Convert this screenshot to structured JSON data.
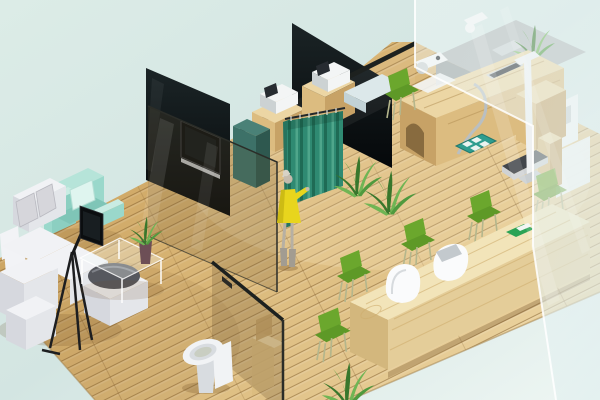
{
  "scene": {
    "alt": "Isometric 3D render of a small clinic interior with waiting lounge, exam stations behind glass partitions, privacy curtain, standing person, toilet stall and a long wooden reception counter with green chairs"
  },
  "objects": {
    "lounge_sofa": "white sectional sofa",
    "mint_armchair": "mint green armchair",
    "tripod_display": "flat display on tripod stand",
    "coffee_table": "glass coffee table",
    "table_plant": "potted plant in vase",
    "tv_wall": "black glass partition with wall TV",
    "wall_tv": "wall mounted TV",
    "privacy_curtain": "teal privacy curtain",
    "standing_person": "woman in yellow dress",
    "exam_cabinets": "wooden cabinets with medical devices",
    "exam_desk": "wooden examination desk",
    "exam_bed": "light exam table",
    "height_stand": "white height measuring stand",
    "weighing_scale": "floor weighing scale",
    "floor_mat": "teal mat with white pads",
    "back_counter": "gray back counter with equipment",
    "frosted_wall": "frosted glass wall",
    "toilet": "white toilet",
    "toilet_stall": "glass toilet stall",
    "reception_desk": "long light-wood reception counter",
    "waiting_chairs": "green waiting chairs",
    "reception_monitor": "white monitor on counter",
    "reception_chair": "white designer chair",
    "desk_tray": "green tray on counter",
    "floor_plants": "leafy green plants"
  },
  "palette": {
    "bgTop": "#dcece7",
    "bgMid": "#d3e5e2",
    "bgLight": "#eef6f3",
    "floorDark": "#c09552",
    "floorMid": "#d6b170",
    "floorLight": "#e9d09b",
    "plank": "#7d5a2a",
    "floorEdge": "#a58550",
    "floorGlow": "#fff3d4",
    "wallTop": "#1b2426",
    "wallBottom": "#05080a",
    "rail": "#1d211f",
    "tvFrame": "#34383b",
    "tvScreen": "#0b0e10",
    "tvShelf": "#b9bdc0",
    "tealCab": "#3d7168",
    "tealCabSide": "#2e584f",
    "tealCabTop": "#4a8177",
    "glassWarm": "#6b5632",
    "glassEdge": "#2b2d28",
    "frostA": "#f4fafa",
    "frostB": "#dfeeee",
    "frostEdge": "#ffffff",
    "curtain": "#2f8a72",
    "curtainDark": "#1f6b55",
    "curtainLight": "#55ab90",
    "curtainPanel": "#27745f",
    "woodTop": "#ecd6a4",
    "woodFront": "#dcbc80",
    "woodSide": "#c7a266",
    "woodGrain": "#b08c4f",
    "archDark": "#7c6138",
    "deviceWhite": "#f3f5f5",
    "deviceGray": "#ccd2d3",
    "deviceScreen": "#272c31",
    "chrome": "#b9bfc2",
    "grayCounter": "#b3b9b9",
    "grayCounterFront": "#99a1a1",
    "bedSlab": "#dce8ea",
    "bedSlabFront": "#c2d2d6",
    "dress": "#e8d51d",
    "dressShade": "#cdbb14",
    "skin": "#c5bbad",
    "hair": "#d8d2c6",
    "legs": "#b7b0a3",
    "boots": "#a29c91",
    "mintChair": "#b6e4d9",
    "mintDark": "#9ad8cb",
    "mintLight": "#c9ece3",
    "mintInner": "#8ccfc1",
    "mintSeat": "#7fc5b7",
    "pillow": "#dff5ef",
    "sofaTop": "#f1f2f5",
    "sofaFront": "#e4e6ea",
    "sofaSide": "#d6d8de",
    "cushionGray": "#d6d6db",
    "cushionWhite": "#f2f3f6",
    "bowlDark": "#56585e",
    "bowlLight": "#8a8d94",
    "tableGlass": "#f6fbfa",
    "tableEdge": "#ffffff",
    "potDark": "#6d4f56",
    "plantGreen": "#4f9a3e",
    "plantDarkGreen": "#38772c",
    "plantLight": "#6fb554",
    "chairGreen": "#6ba72d",
    "chairGreenDark": "#5e9927",
    "chairLeg": "#b4b68c",
    "recTop": "#f2e4b9",
    "recFront": "#e4cd99",
    "recSide": "#d3b77d",
    "recGrain": "#cfae6e",
    "whiteFurn": "#fafbfc",
    "whiteShade": "#d7dbde",
    "monScreen": "#c3c9cd",
    "trayGreen": "#2ba355",
    "trayWhite": "#f2f5f2",
    "toiletWhite": "#f1f3f5",
    "toiletShade": "#d8dce0",
    "toiletInner": "#c9cec2",
    "scaleDark": "#42464b",
    "scaleBase": "#cfd2d4",
    "standWhite": "#eff1f2",
    "standShade": "#c9ced1",
    "matTeal": "#2e9d8f",
    "matSquare": "#e9f3f0",
    "matEdge": "#22786d",
    "shadow": "#6b4a20"
  }
}
